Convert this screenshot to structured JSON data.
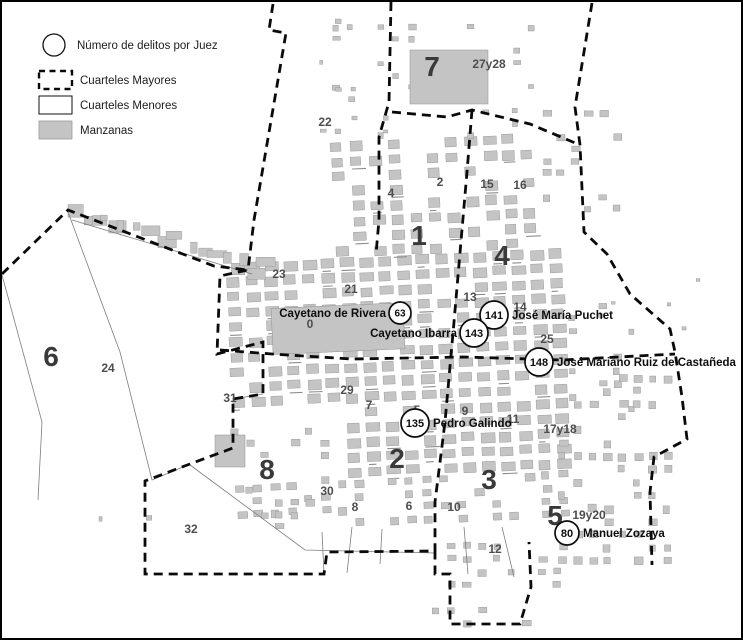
{
  "figure": {
    "type": "historic-city-map",
    "colors": {
      "background": "#ffffff",
      "manzana_gray": "#c4c4c4",
      "manzana_outline": "#909090",
      "boundary_black": "#0a0a0a",
      "marker_fill": "#ffffff",
      "ink": "#0d0d0d"
    }
  },
  "legend": {
    "items": [
      {
        "swatch": "circle-icon",
        "label": "Número de delitos por Juez"
      },
      {
        "swatch": "dashed-box-icon",
        "label": "Cuarteles Mayores"
      },
      {
        "swatch": "white-box-icon",
        "label": "Cuarteles Menores"
      },
      {
        "swatch": "gray-box-icon",
        "label": "Manzanas"
      }
    ]
  },
  "judges": [
    {
      "name": "Cayetano de Rivera",
      "count": "63",
      "cx": 398,
      "cy": 311,
      "r": 11,
      "side": "left"
    },
    {
      "name": "José María Puchet",
      "count": "141",
      "cx": 492,
      "cy": 313,
      "r": 14,
      "side": "right"
    },
    {
      "name": "Cayetano Ibarra",
      "count": "143",
      "cx": 472,
      "cy": 331,
      "r": 14,
      "side": "left"
    },
    {
      "name": "José Mariano Ruiz de Castañeda",
      "count": "148",
      "cx": 537,
      "cy": 360,
      "r": 14,
      "side": "right"
    },
    {
      "name": "Pedro Galindo",
      "count": "135",
      "cx": 413,
      "cy": 421,
      "r": 14,
      "side": "right"
    },
    {
      "name": "Manuel Zozaya",
      "count": "80",
      "cx": 565,
      "cy": 531,
      "r": 12,
      "side": "right"
    }
  ],
  "cuarteles_mayores": [
    {
      "num": "1",
      "x": 417,
      "y": 233
    },
    {
      "num": "2",
      "x": 395,
      "y": 456
    },
    {
      "num": "3",
      "x": 487,
      "y": 477
    },
    {
      "num": "4",
      "x": 500,
      "y": 253
    },
    {
      "num": "5",
      "x": 553,
      "y": 513
    },
    {
      "num": "6",
      "x": 49,
      "y": 354
    },
    {
      "num": "7",
      "x": 430,
      "y": 64
    },
    {
      "num": "8",
      "x": 265,
      "y": 467
    }
  ],
  "cuarteles_menores": [
    {
      "num": "22",
      "x": 323,
      "y": 120
    },
    {
      "num": "27y28",
      "x": 487,
      "y": 62
    },
    {
      "num": "4",
      "x": 389,
      "y": 191
    },
    {
      "num": "2",
      "x": 438,
      "y": 180
    },
    {
      "num": "15",
      "x": 485,
      "y": 182
    },
    {
      "num": "16",
      "x": 518,
      "y": 183
    },
    {
      "num": "13",
      "x": 468,
      "y": 295
    },
    {
      "num": "14",
      "x": 518,
      "y": 305
    },
    {
      "num": "23",
      "x": 277,
      "y": 272
    },
    {
      "num": "21",
      "x": 349,
      "y": 287
    },
    {
      "num": "0",
      "x": 308,
      "y": 322
    },
    {
      "num": "24",
      "x": 106,
      "y": 366
    },
    {
      "num": "25",
      "x": 545,
      "y": 337
    },
    {
      "num": "31",
      "x": 228,
      "y": 396
    },
    {
      "num": "29",
      "x": 345,
      "y": 388
    },
    {
      "num": "7",
      "x": 367,
      "y": 403
    },
    {
      "num": "5",
      "x": 415,
      "y": 408
    },
    {
      "num": "9",
      "x": 463,
      "y": 409
    },
    {
      "num": "11",
      "x": 511,
      "y": 417
    },
    {
      "num": "30",
      "x": 325,
      "y": 489
    },
    {
      "num": "8",
      "x": 353,
      "y": 505
    },
    {
      "num": "6",
      "x": 407,
      "y": 504
    },
    {
      "num": "10",
      "x": 452,
      "y": 505
    },
    {
      "num": "32",
      "x": 189,
      "y": 527
    },
    {
      "num": "12",
      "x": 493,
      "y": 547
    },
    {
      "num": "17y18",
      "x": 558,
      "y": 427
    },
    {
      "num": "19y20",
      "x": 587,
      "y": 513
    }
  ]
}
